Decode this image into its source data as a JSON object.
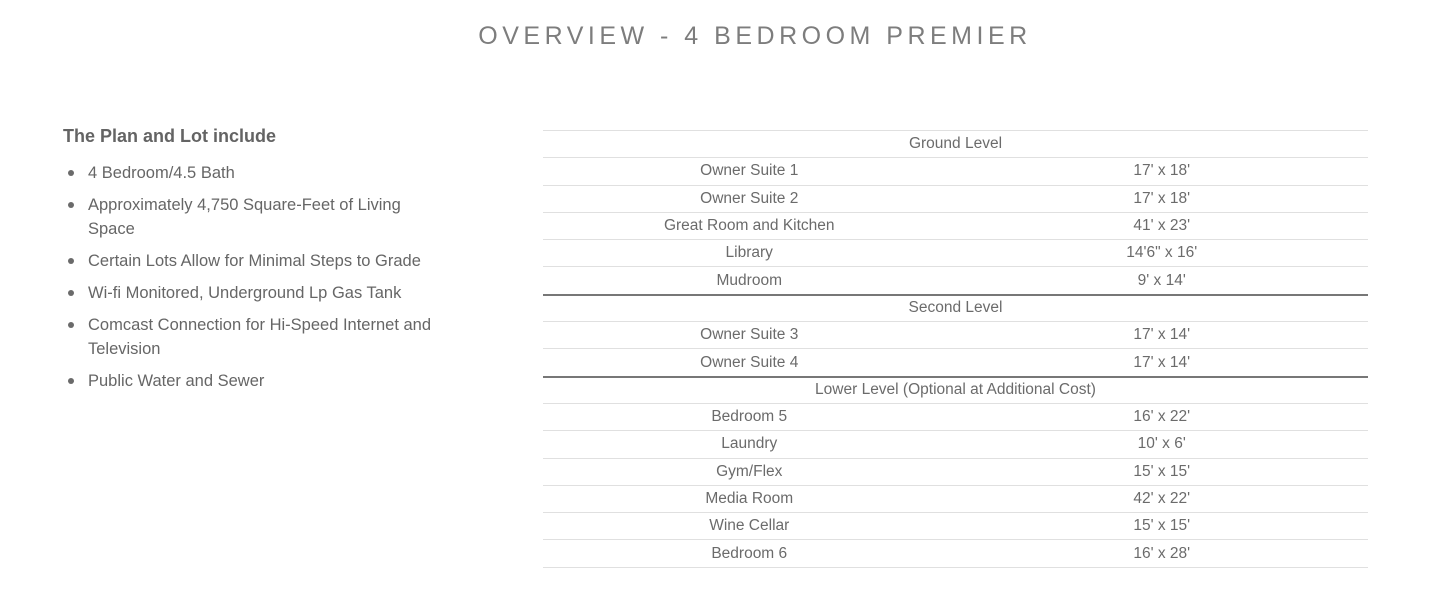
{
  "header": {
    "title": "OVERVIEW - 4 BEDROOM PREMIER"
  },
  "plan": {
    "heading": "The Plan and Lot include",
    "items": [
      "4 Bedroom/4.5 Bath",
      "Approximately 4,750 Square-Feet of Living Space",
      "Certain Lots Allow for Minimal Steps to Grade",
      "Wi-fi Monitored, Underground Lp Gas Tank",
      "Comcast Connection for Hi-Speed Internet and Television",
      "Public Water and Sewer"
    ]
  },
  "room_table": {
    "sections": [
      {
        "label": "Ground Level",
        "rows": [
          {
            "room": "Owner Suite 1",
            "size": "17' x 18'"
          },
          {
            "room": "Owner Suite 2",
            "size": "17' x 18'"
          },
          {
            "room": "Great Room and Kitchen",
            "size": "41' x 23'"
          },
          {
            "room": "Library",
            "size": "14'6\" x 16'"
          },
          {
            "room": "Mudroom",
            "size": "9' x 14'"
          }
        ]
      },
      {
        "label": "Second Level",
        "rows": [
          {
            "room": "Owner Suite 3",
            "size": "17' x 14'"
          },
          {
            "room": "Owner Suite 4",
            "size": "17' x 14'"
          }
        ]
      },
      {
        "label": "Lower Level (Optional at Additional Cost)",
        "rows": [
          {
            "room": "Bedroom 5",
            "size": "16' x 22'"
          },
          {
            "room": "Laundry",
            "size": "10' x 6'"
          },
          {
            "room": "Gym/Flex",
            "size": "15' x 15'"
          },
          {
            "room": "Media Room",
            "size": "42' x 22'"
          },
          {
            "room": "Wine Cellar",
            "size": "15' x 15'"
          },
          {
            "room": "Bedroom 6",
            "size": "16' x 28'"
          }
        ]
      }
    ]
  },
  "colors": {
    "background": "#ffffff",
    "title_text": "#7d7d7d",
    "body_text": "#666666",
    "table_text": "#6b6b6b",
    "row_divider": "#e0e0e0",
    "section_divider": "#777777"
  }
}
